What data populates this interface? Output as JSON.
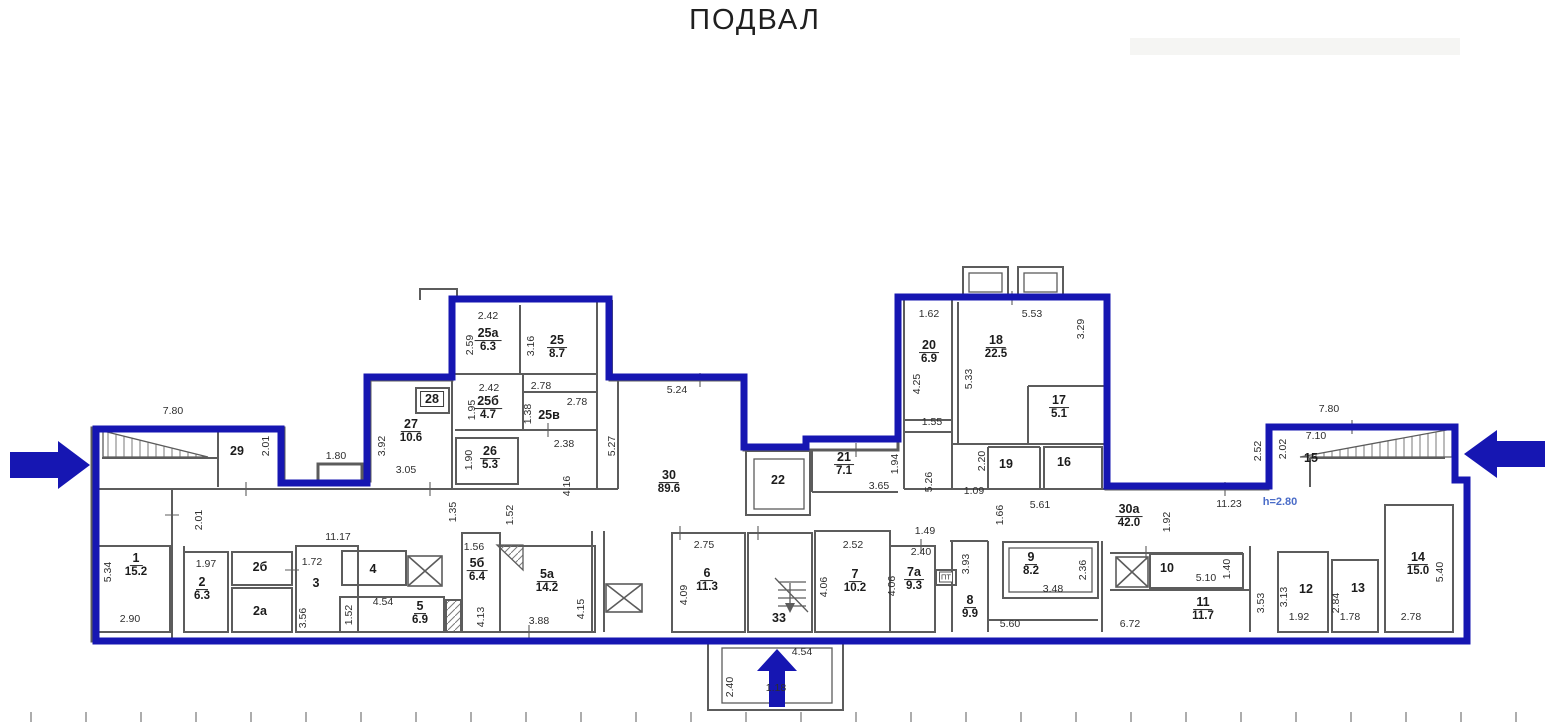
{
  "title": "ПОДВАЛ",
  "colors": {
    "outline_blue": "#1616b2",
    "wall_gray": "#5c5c5c",
    "dim_text": "#2e2e2e",
    "height_note_blue": "#4a6cc8"
  },
  "plan": {
    "rooms": [
      {
        "num": "1",
        "area": "15.2",
        "x": 136,
        "y": 565
      },
      {
        "num": "2",
        "area": "6.3",
        "x": 202,
        "y": 589
      },
      {
        "num": "2а",
        "x": 260,
        "y": 611
      },
      {
        "num": "2б",
        "x": 260,
        "y": 567
      },
      {
        "num": "3",
        "x": 316,
        "y": 583
      },
      {
        "num": "4",
        "x": 373,
        "y": 569
      },
      {
        "num": "5",
        "area": "6.9",
        "x": 420,
        "y": 613
      },
      {
        "num": "5а",
        "area": "14.2",
        "x": 547,
        "y": 581
      },
      {
        "num": "5б",
        "area": "6.4",
        "x": 477,
        "y": 570
      },
      {
        "num": "6",
        "area": "11.3",
        "x": 707,
        "y": 580
      },
      {
        "num": "7",
        "area": "10.2",
        "x": 855,
        "y": 581
      },
      {
        "num": "7а",
        "area": "9.3",
        "x": 914,
        "y": 579
      },
      {
        "num": "8",
        "area": "9.9",
        "x": 970,
        "y": 607
      },
      {
        "num": "9",
        "area": "8.2",
        "x": 1031,
        "y": 564
      },
      {
        "num": "10",
        "x": 1167,
        "y": 568
      },
      {
        "num": "11",
        "area": "11.7",
        "x": 1203,
        "y": 609
      },
      {
        "num": "12",
        "x": 1306,
        "y": 589
      },
      {
        "num": "13",
        "x": 1358,
        "y": 588
      },
      {
        "num": "14",
        "area": "15.0",
        "x": 1418,
        "y": 564
      },
      {
        "num": "15",
        "x": 1311,
        "y": 458
      },
      {
        "num": "16",
        "x": 1064,
        "y": 462
      },
      {
        "num": "17",
        "area": "5.1",
        "x": 1059,
        "y": 407
      },
      {
        "num": "18",
        "area": "22.5",
        "x": 996,
        "y": 347
      },
      {
        "num": "19",
        "x": 1006,
        "y": 464
      },
      {
        "num": "20",
        "area": "6.9",
        "x": 929,
        "y": 352
      },
      {
        "num": "21",
        "area": "7.1",
        "x": 844,
        "y": 464
      },
      {
        "num": "22",
        "x": 778,
        "y": 480
      },
      {
        "num": "25",
        "area": "8.7",
        "x": 557,
        "y": 347
      },
      {
        "num": "25а",
        "area": "6.3",
        "x": 488,
        "y": 340
      },
      {
        "num": "25б",
        "area": "4.7",
        "x": 488,
        "y": 408
      },
      {
        "num": "25в",
        "x": 549,
        "y": 415
      },
      {
        "num": "26",
        "area": "5.3",
        "x": 490,
        "y": 458
      },
      {
        "num": "27",
        "area": "10.6",
        "x": 411,
        "y": 431
      },
      {
        "num": "28",
        "x": 432,
        "y": 399,
        "boxed": true
      },
      {
        "num": "29",
        "x": 237,
        "y": 451
      },
      {
        "num": "30",
        "area": "89.6",
        "x": 669,
        "y": 482
      },
      {
        "num": "30а",
        "area": "42.0",
        "x": 1129,
        "y": 516
      },
      {
        "num": "33",
        "x": 779,
        "y": 618
      }
    ],
    "dims": [
      {
        "t": "7.80",
        "x": 173,
        "y": 411
      },
      {
        "t": "2.01",
        "x": 266,
        "y": 446,
        "r": 1
      },
      {
        "t": "1.80",
        "x": 336,
        "y": 456
      },
      {
        "t": "3.92",
        "x": 382,
        "y": 446,
        "r": 1
      },
      {
        "t": "3.05",
        "x": 406,
        "y": 470
      },
      {
        "t": "2.42",
        "x": 488,
        "y": 316
      },
      {
        "t": "2.59",
        "x": 470,
        "y": 345,
        "r": 1
      },
      {
        "t": "3.16",
        "x": 531,
        "y": 346,
        "r": 1
      },
      {
        "t": "2.42",
        "x": 489,
        "y": 388
      },
      {
        "t": "1.95",
        "x": 472,
        "y": 410,
        "r": 1
      },
      {
        "t": "2.78",
        "x": 541,
        "y": 386
      },
      {
        "t": "1.38",
        "x": 528,
        "y": 414,
        "r": 1
      },
      {
        "t": "2.78",
        "x": 577,
        "y": 402
      },
      {
        "t": "2.38",
        "x": 564,
        "y": 444
      },
      {
        "t": "1.90",
        "x": 469,
        "y": 460,
        "r": 1
      },
      {
        "t": "4.16",
        "x": 567,
        "y": 486,
        "r": 1
      },
      {
        "t": "5.27",
        "x": 612,
        "y": 446,
        "r": 1
      },
      {
        "t": "5.24",
        "x": 677,
        "y": 390
      },
      {
        "t": "1.35",
        "x": 453,
        "y": 512,
        "r": 1
      },
      {
        "t": "1.52",
        "x": 510,
        "y": 515,
        "r": 1
      },
      {
        "t": "1.56",
        "x": 474,
        "y": 547
      },
      {
        "t": "4.13",
        "x": 481,
        "y": 617,
        "r": 1
      },
      {
        "t": "3.88",
        "x": 539,
        "y": 621
      },
      {
        "t": "4.15",
        "x": 581,
        "y": 609,
        "r": 1
      },
      {
        "t": "11.17",
        "x": 338,
        "y": 537
      },
      {
        "t": "1.97",
        "x": 206,
        "y": 564
      },
      {
        "t": "5.34",
        "x": 108,
        "y": 572,
        "r": 1
      },
      {
        "t": "2.90",
        "x": 130,
        "y": 619
      },
      {
        "t": "2.01",
        "x": 199,
        "y": 520,
        "r": 1
      },
      {
        "t": "1.72",
        "x": 312,
        "y": 562
      },
      {
        "t": "3.56",
        "x": 303,
        "y": 618,
        "r": 1
      },
      {
        "t": "1.52",
        "x": 349,
        "y": 615,
        "r": 1
      },
      {
        "t": "4.54",
        "x": 383,
        "y": 602
      },
      {
        "t": "2.75",
        "x": 704,
        "y": 545
      },
      {
        "t": "4.09",
        "x": 684,
        "y": 595,
        "r": 1
      },
      {
        "t": "2.52",
        "x": 853,
        "y": 545
      },
      {
        "t": "4.06",
        "x": 824,
        "y": 587,
        "r": 1
      },
      {
        "t": "4.06",
        "x": 892,
        "y": 586,
        "r": 1
      },
      {
        "t": "2.40",
        "x": 921,
        "y": 552
      },
      {
        "t": "1.49",
        "x": 925,
        "y": 531
      },
      {
        "t": "3.93",
        "x": 966,
        "y": 564,
        "r": 1
      },
      {
        "t": "5.60",
        "x": 1010,
        "y": 624
      },
      {
        "t": "3.48",
        "x": 1053,
        "y": 589
      },
      {
        "t": "2.36",
        "x": 1083,
        "y": 570,
        "r": 1
      },
      {
        "t": "6.72",
        "x": 1130,
        "y": 624
      },
      {
        "t": "5.10",
        "x": 1206,
        "y": 578
      },
      {
        "t": "1.40",
        "x": 1227,
        "y": 569,
        "r": 1
      },
      {
        "t": "1.92",
        "x": 1299,
        "y": 617
      },
      {
        "t": "3.13",
        "x": 1284,
        "y": 597,
        "r": 1
      },
      {
        "t": "1.78",
        "x": 1350,
        "y": 617
      },
      {
        "t": "2.84",
        "x": 1336,
        "y": 603,
        "r": 1
      },
      {
        "t": "2.78",
        "x": 1411,
        "y": 617
      },
      {
        "t": "5.40",
        "x": 1440,
        "y": 572,
        "r": 1
      },
      {
        "t": "3.53",
        "x": 1261,
        "y": 603,
        "r": 1
      },
      {
        "t": "11.23",
        "x": 1229,
        "y": 504
      },
      {
        "t": "1.92",
        "x": 1167,
        "y": 522,
        "r": 1
      },
      {
        "t": "5.61",
        "x": 1040,
        "y": 505
      },
      {
        "t": "1.66",
        "x": 1000,
        "y": 515,
        "r": 1
      },
      {
        "t": "1.09",
        "x": 974,
        "y": 491
      },
      {
        "t": "2.20",
        "x": 982,
        "y": 461,
        "r": 1
      },
      {
        "t": "5.26",
        "x": 929,
        "y": 482,
        "r": 1
      },
      {
        "t": "1.55",
        "x": 932,
        "y": 422
      },
      {
        "t": "4.25",
        "x": 917,
        "y": 384,
        "r": 1
      },
      {
        "t": "1.62",
        "x": 929,
        "y": 314
      },
      {
        "t": "5.53",
        "x": 1032,
        "y": 314
      },
      {
        "t": "3.29",
        "x": 1081,
        "y": 329,
        "r": 1
      },
      {
        "t": "5.33",
        "x": 969,
        "y": 379,
        "r": 1
      },
      {
        "t": "3.65",
        "x": 879,
        "y": 486
      },
      {
        "t": "1.94",
        "x": 895,
        "y": 464,
        "r": 1
      },
      {
        "t": "7.80",
        "x": 1329,
        "y": 409
      },
      {
        "t": "7.10",
        "x": 1316,
        "y": 436
      },
      {
        "t": "2.02",
        "x": 1283,
        "y": 449,
        "r": 1
      },
      {
        "t": "2.52",
        "x": 1258,
        "y": 451,
        "r": 1
      },
      {
        "t": "4.54",
        "x": 802,
        "y": 652
      },
      {
        "t": "2.40",
        "x": 730,
        "y": 687,
        "r": 1
      },
      {
        "t": "1.18",
        "x": 776,
        "y": 688
      }
    ],
    "annotations": [
      {
        "t": "h=2.80",
        "x": 1280,
        "y": 502,
        "kind": "blue"
      },
      {
        "t": "ПТ",
        "x": 946,
        "y": 577,
        "kind": "pt"
      }
    ]
  }
}
